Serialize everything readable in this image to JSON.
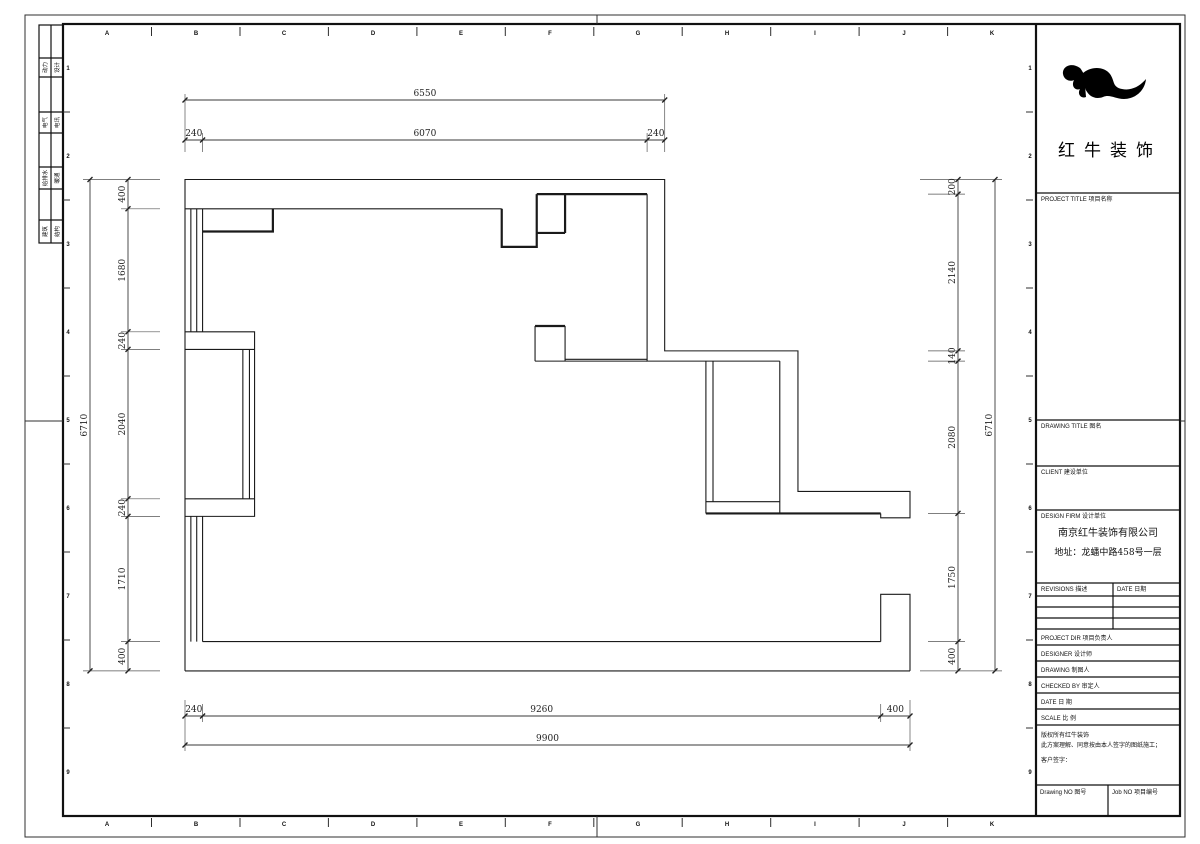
{
  "sheet": {
    "frame": {
      "columns": [
        "A",
        "B",
        "C",
        "D",
        "E",
        "F",
        "G",
        "H",
        "I",
        "J",
        "K"
      ],
      "rows": [
        "1",
        "2",
        "3",
        "4",
        "5",
        "6",
        "7",
        "8",
        "9"
      ]
    },
    "disciplines": [
      {
        "left": "动力",
        "right": "设计"
      },
      {
        "left": "电气",
        "right": "电讯"
      },
      {
        "left": "给排水",
        "right": "暖通"
      },
      {
        "left": "建筑",
        "right": "结构"
      }
    ]
  },
  "title_block": {
    "logo_icon": "redbull-swoosh",
    "company_logo_name": "红牛装饰",
    "project_title_label": "PROJECT TITLE    项目名称",
    "drawing_title_label": "DRAWING TITLE    图名",
    "client_label": "CLIENT   建设单位",
    "design_firm_label": "DESIGN FIRM   设计单位",
    "design_firm_name": "南京红牛装饰有限公司",
    "design_firm_address": "地址：龙蟠中路458号一层",
    "revisions_label": "REVISIONS 描述",
    "date_col_label": "DATE 日期",
    "project_dir_label": "PROJECT DIR    项目负责人",
    "designer_label": "DESIGNER    设计师",
    "drawing_label": "DRAWING    制图人",
    "checked_by_label": "CHECKED BY    审定人",
    "date_label": "DATE         日 期",
    "scale_label": "SCALE        比 例",
    "copyright_line1": "版权所有红牛装饰",
    "copyright_line2": "此方案理解、同意按由本人签字的图纸施工；",
    "copyright_line3": "客户签字：",
    "drawing_no_label": "Drawing NO  图号",
    "job_no_label": "Job NO  项目编号"
  },
  "dimensions": {
    "top": {
      "overall": "6550",
      "chain": [
        "240",
        "6070",
        "240"
      ]
    },
    "left": {
      "overall": "6710",
      "chain": [
        "400",
        "1680",
        "240",
        "2040",
        "240",
        "1710",
        "400"
      ]
    },
    "right": {
      "overall": "6710",
      "chain": [
        "200",
        "2140",
        "140",
        "2080",
        "1750",
        "400"
      ]
    },
    "bottom": {
      "overall": "9900",
      "chain": [
        "240",
        "9260",
        "400"
      ]
    }
  }
}
